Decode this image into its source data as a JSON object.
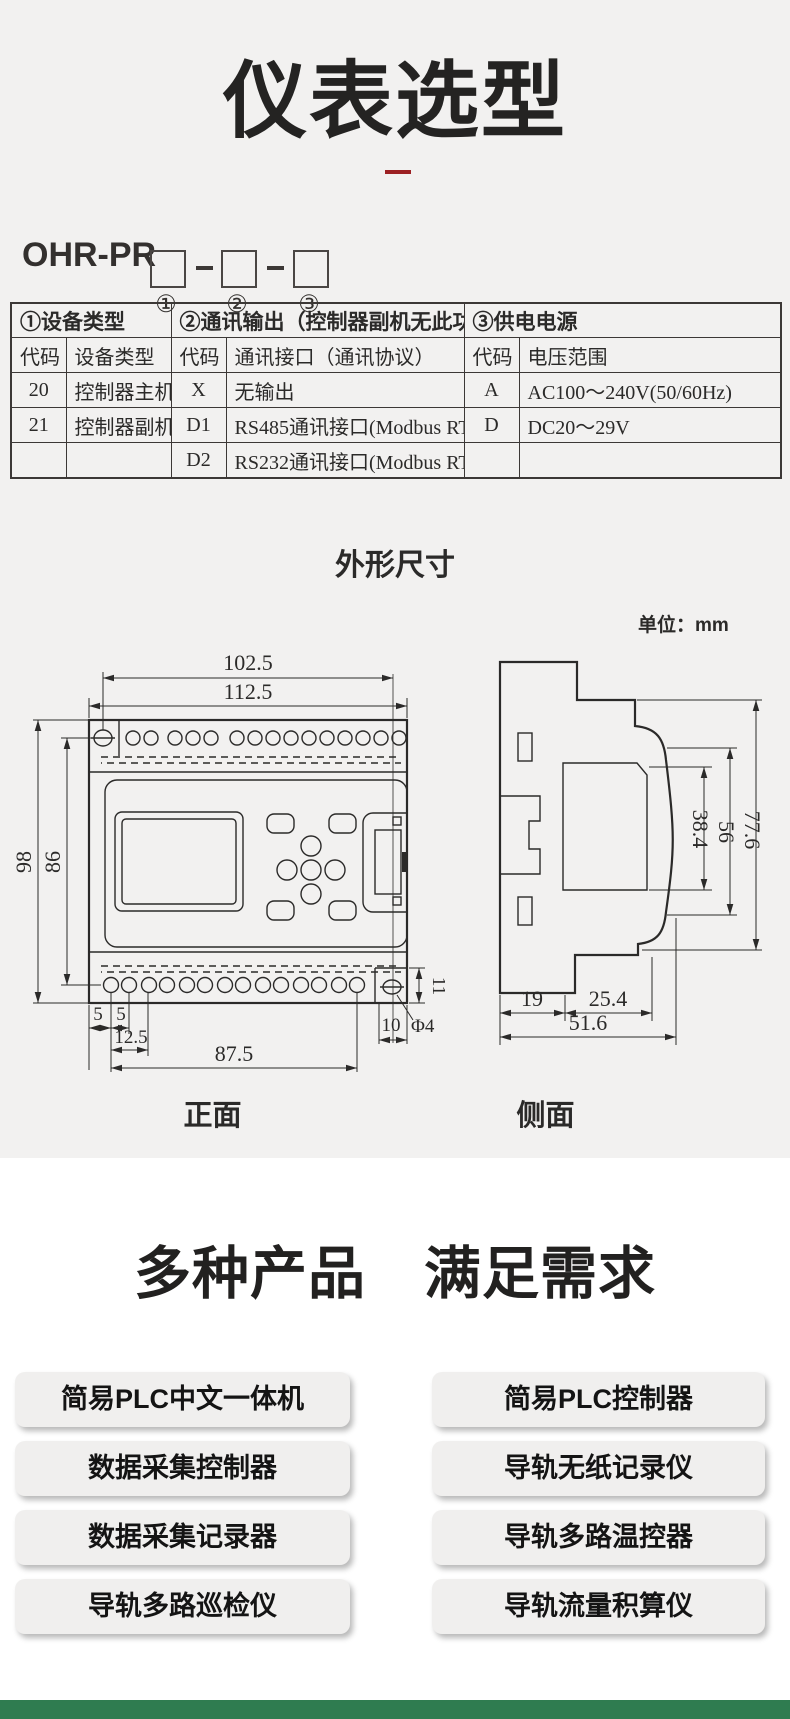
{
  "page": {
    "title": "仪表选型",
    "model_prefix": "OHR-PR",
    "position_labels": [
      "①",
      "②",
      "③"
    ]
  },
  "selection_table": {
    "groups": [
      {
        "title": "①设备类型",
        "col_headers": [
          "代码",
          "设备类型"
        ],
        "rows": [
          [
            "20",
            "控制器主机"
          ],
          [
            "21",
            "控制器副机"
          ],
          [
            "",
            ""
          ]
        ]
      },
      {
        "title": "②通讯输出（控制器副机无此功能）",
        "col_headers": [
          "代码",
          "通讯接口（通讯协议）"
        ],
        "rows": [
          [
            "X",
            "无输出"
          ],
          [
            "D1",
            "RS485通讯接口(Modbus RTU)"
          ],
          [
            "D2",
            "RS232通讯接口(Modbus RTU)"
          ]
        ]
      },
      {
        "title": "③供电电源",
        "col_headers": [
          "代码",
          "电压范围"
        ],
        "rows": [
          [
            "A",
            "AC100～240V(50/60Hz)"
          ],
          [
            "D",
            "DC20～29V"
          ],
          [
            "",
            ""
          ]
        ]
      }
    ]
  },
  "dimensions": {
    "heading": "外形尺寸",
    "unit_label": "单位：mm",
    "front": {
      "label": "正面",
      "width_inner": "102.5",
      "width_outer": "112.5",
      "height_outer": "98",
      "height_inner": "86",
      "d5a": "5",
      "d5b": "5",
      "d12_5": "12.5",
      "d87_5": "87.5",
      "d10": "10",
      "d11": "11",
      "phi4": "Φ4"
    },
    "side": {
      "label": "侧面",
      "d38_4": "38.4",
      "d56": "56",
      "d77_6": "77.6",
      "d19": "19",
      "d25_4": "25.4",
      "d51_6": "51.6"
    }
  },
  "products": {
    "heading": "多种产品　满足需求",
    "left": [
      "简易PLC中文一体机",
      "数据采集控制器",
      "数据采集记录器",
      "导轨多路巡检仪"
    ],
    "right": [
      "简易PLC控制器",
      "导轨无纸记录仪",
      "导轨多路温控器",
      "导轨流量积算仪"
    ]
  },
  "colors": {
    "accent_red": "#9c2023",
    "footer_green": "#2f7c50",
    "page_gray": "#f2f1f0",
    "line_dark": "#2b2a29"
  }
}
